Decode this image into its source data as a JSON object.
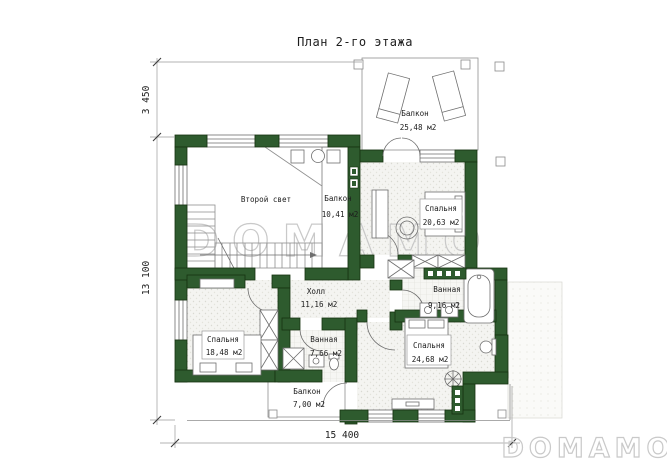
{
  "title": "План 2-го этажа",
  "dimensions": {
    "balcony_depth": "3 450",
    "house_depth": "13 100",
    "house_width": "15 400"
  },
  "rooms": [
    {
      "id": "balcony-top",
      "name": "Балкон",
      "area": "25,48 м2"
    },
    {
      "id": "second-light",
      "name": "Второй свет",
      "area": ""
    },
    {
      "id": "inner-balcony",
      "name": "Балкон",
      "area": "10,41 м2"
    },
    {
      "id": "bedroom-1",
      "name": "Спальня",
      "area": "20,63 м2"
    },
    {
      "id": "hall",
      "name": "Холл",
      "area": "11,16 м2"
    },
    {
      "id": "bathroom-1",
      "name": "Ванная",
      "area": "9,16 м2"
    },
    {
      "id": "bedroom-2",
      "name": "Спальня",
      "area": "18,48 м2"
    },
    {
      "id": "bathroom-2",
      "name": "Ванная",
      "area": "7,66 м2"
    },
    {
      "id": "bedroom-3",
      "name": "Спальня",
      "area": "24,68 м2"
    },
    {
      "id": "balcony-bottom",
      "name": "Балкон",
      "area": "7,00 м2"
    }
  ],
  "watermarks": {
    "center": "DOMAMO",
    "corner": "DOMAMO"
  },
  "colors": {
    "wall": "#2e5b2e",
    "wall_outline": "#16330f",
    "line": "#8f8f8f",
    "furn": "#6e6e6e",
    "text": "#1c1c1c",
    "watermark": "#c9c9c9"
  }
}
